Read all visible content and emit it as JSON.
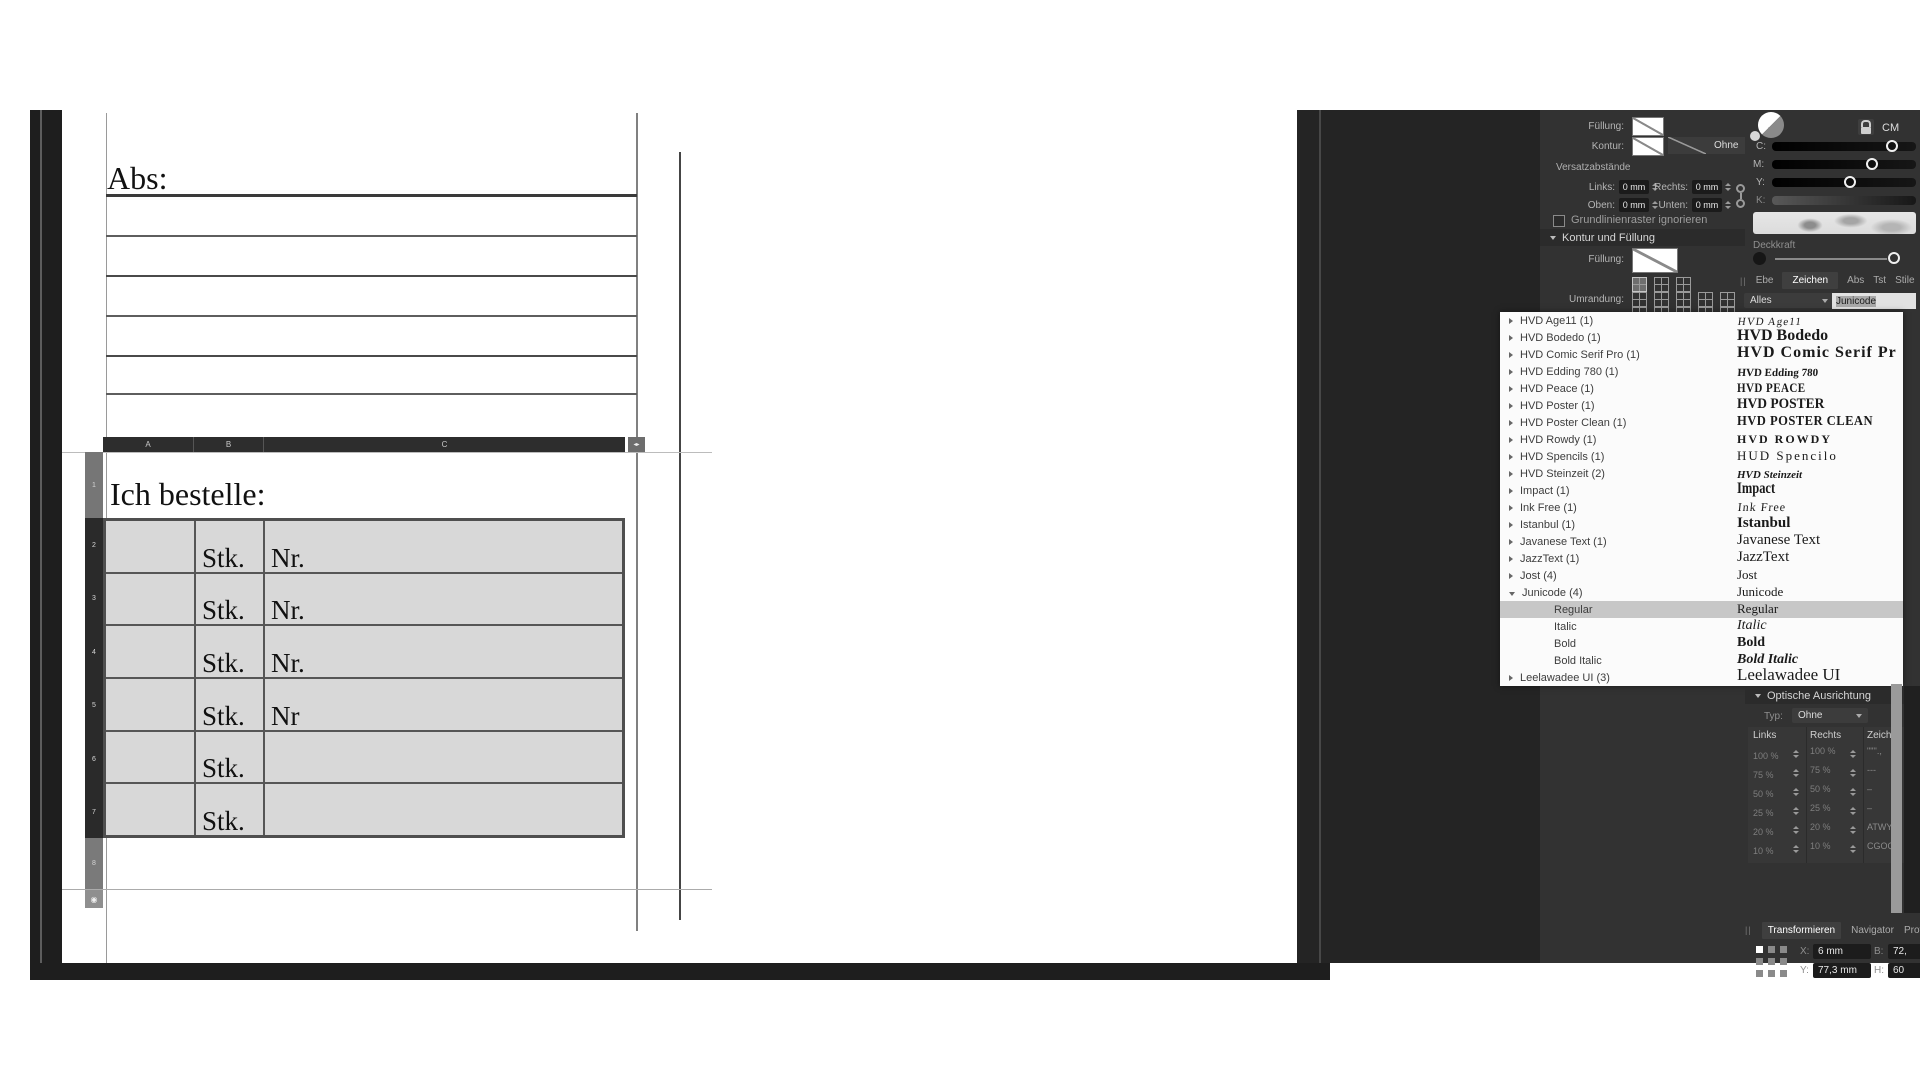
{
  "document": {
    "abs_label": "Abs:",
    "order_label": "Ich bestelle:",
    "columns": [
      "A",
      "B",
      "C"
    ],
    "row_numbers": [
      "1",
      "2",
      "3",
      "4",
      "5",
      "6",
      "7",
      "8"
    ],
    "table_rows": [
      {
        "a": "",
        "b": "Stk.",
        "c": "Nr."
      },
      {
        "a": "",
        "b": "Stk.",
        "c": "Nr."
      },
      {
        "a": "",
        "b": "Stk.",
        "c": "Nr."
      },
      {
        "a": "",
        "b": "Stk.",
        "c": "Nr"
      },
      {
        "a": "",
        "b": "Stk.",
        "c": ""
      },
      {
        "a": "",
        "b": "Stk.",
        "c": ""
      }
    ]
  },
  "text_frame_panel": {
    "fill_label": "Füllung:",
    "stroke_label": "Kontur:",
    "stroke_style_value": "Ohne",
    "offsets_title": "Versatzabstände",
    "left_label": "Links:",
    "right_label": "Rechts:",
    "top_label": "Oben:",
    "bottom_label": "Unten:",
    "left_value": "0 mm",
    "right_value": "0 mm",
    "top_value": "0 mm",
    "bottom_value": "0 mm",
    "baseline_checkbox_label": "Grundlinienraster ignorieren",
    "section_title": "Kontur und Füllung",
    "fill2_label": "Füllung:",
    "border_label": "Umrandung:"
  },
  "color_panel": {
    "mode_label": "CM",
    "channels": [
      "C:",
      "M:",
      "Y:",
      "K:"
    ],
    "opacity_label": "Deckkraft"
  },
  "panel_tabs": {
    "grip": "||",
    "items": [
      "Ebe",
      "Zeichen",
      "Abs",
      "Tst",
      "Stile",
      "Fid"
    ],
    "active": "Zeichen"
  },
  "font_browser": {
    "filter_value": "Alles",
    "search_value": "Junicode",
    "rows": [
      {
        "label": "HVD Age11 (1)",
        "preview": "HVD Age11"
      },
      {
        "label": "HVD Bodedo (1)",
        "preview": "HVD Bodedo"
      },
      {
        "label": "HVD Comic Serif Pro (1)",
        "preview": "HVD Comic Serif Pr"
      },
      {
        "label": "HVD Edding 780 (1)",
        "preview": "HVD Edding 780"
      },
      {
        "label": "HVD Peace (1)",
        "preview": "HVD PEACE"
      },
      {
        "label": "HVD Poster (1)",
        "preview": "HVD POSTER"
      },
      {
        "label": "HVD Poster Clean (1)",
        "preview": "HVD POSTER CLEAN"
      },
      {
        "label": "HVD Rowdy (1)",
        "preview": "HVD ROWDY"
      },
      {
        "label": "HVD Spencils (1)",
        "preview": "HUD Spencilo"
      },
      {
        "label": "HVD Steinzeit (2)",
        "preview": "HVD Steinzeit"
      },
      {
        "label": "Impact (1)",
        "preview": "Impact"
      },
      {
        "label": "Ink Free (1)",
        "preview": "Ink Free"
      },
      {
        "label": "Istanbul (1)",
        "preview": "Istanbul"
      },
      {
        "label": "Javanese Text (1)",
        "preview": "Javanese Text"
      },
      {
        "label": "JazzText (1)",
        "preview": "JazzText"
      },
      {
        "label": "Jost (4)",
        "preview": "Jost"
      },
      {
        "label": "Junicode (4)",
        "preview": "Junicode"
      },
      {
        "label": "Regular",
        "preview": "Regular"
      },
      {
        "label": "Italic",
        "preview": "Italic"
      },
      {
        "label": "Bold",
        "preview": "Bold"
      },
      {
        "label": "Bold Italic",
        "preview": "Bold Italic"
      },
      {
        "label": "Leelawadee UI (3)",
        "preview": "Leelawadee UI"
      }
    ],
    "selected_row": "Regular"
  },
  "optical_panel": {
    "title": "Optische Ausrichtung",
    "type_label": "Typ:",
    "type_value": "Ohne",
    "columns": [
      "Links",
      "Rechts",
      "Zeichen"
    ],
    "rows": [
      {
        "links": "100 %",
        "rechts": "100 %",
        "zeichen": "\"\"''.,"
      },
      {
        "links": "75 %",
        "rechts": "75 %",
        "zeichen": "---"
      },
      {
        "links": "50 %",
        "rechts": "50 %",
        "zeichen": "–"
      },
      {
        "links": "25 %",
        "rechts": "25 %",
        "zeichen": "–"
      },
      {
        "links": "20 %",
        "rechts": "20 %",
        "zeichen": "ATWY"
      },
      {
        "links": "10 %",
        "rechts": "10 %",
        "zeichen": "CGOQ()"
      }
    ]
  },
  "transform_panel": {
    "grip": "||",
    "tabs": [
      "Transformieren",
      "Navigator",
      "Protoko"
    ],
    "active": "Transformieren",
    "x_label": "X:",
    "x_value": "6 mm",
    "y_label": "Y:",
    "y_value": "77,3 mm",
    "w_label": "B:",
    "w_value": "72,",
    "h_label": "H:",
    "h_value": "60"
  },
  "colors": {
    "panel_bg": "#323232",
    "selection_gray": "#c7c7c7",
    "table_selection_fill": "#d8d8d8"
  }
}
